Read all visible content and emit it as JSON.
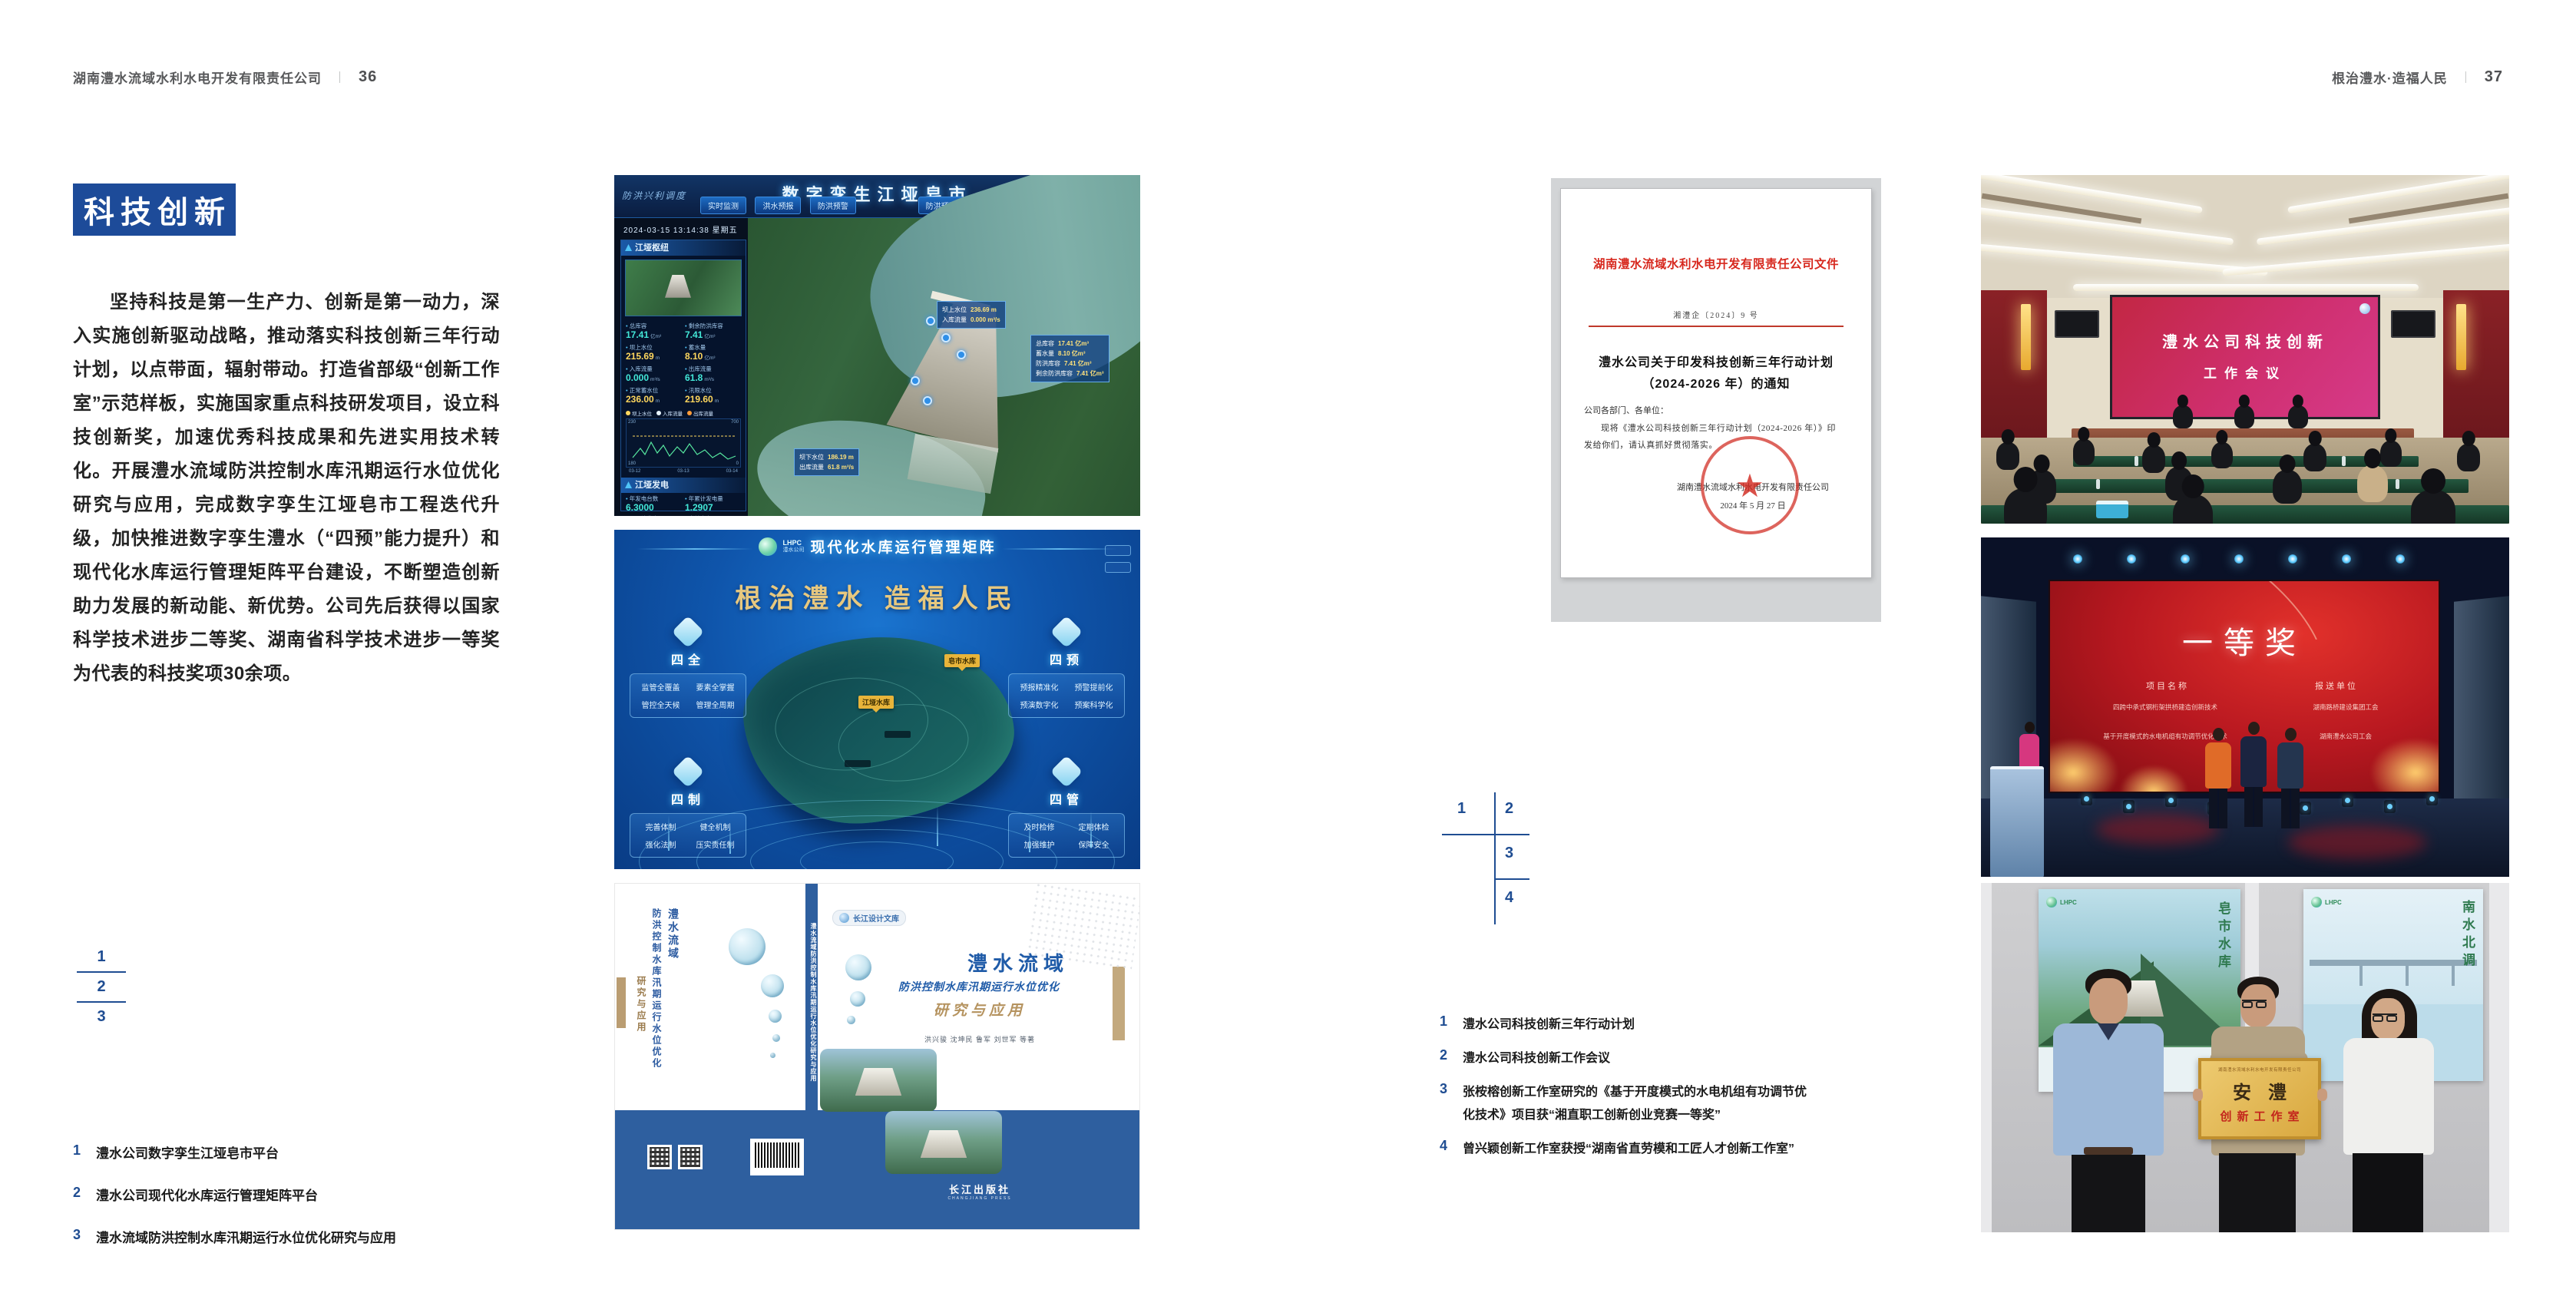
{
  "colors": {
    "accent_blue": "#1d4b99",
    "index_blue": "#1f4d92",
    "doc_red": "#d7281e",
    "gold": "#c9a063"
  },
  "left_page": {
    "header": {
      "company": "湖南澧水流域水利水电开发有限责任公司",
      "divider": "｜",
      "page": "36"
    },
    "badge": "科技创新",
    "paragraph": "坚持科技是第一生产力、创新是第一动力，深入实施创新驱动战略，推动落实科技创新三年行动计划，以点带面，辐射带动。打造省部级“创新工作室”示范样板，实施国家重点科技研发项目，设立科技创新奖，加速优秀科技成果和先进实用技术转化。开展澧水流域防洪控制水库汛期运行水位优化研究与应用，完成数字孪生江垭皂市工程迭代升级，加快推进数字孪生澧水（“四预”能力提升）和现代化水库运行管理矩阵平台建设，不断塑造创新助力发展的新动能、新优势。公司先后获得以国家科学技术进步二等奖、湖南省科学技术进步一等奖为代表的科技奖项30余项。",
    "index": [
      "1",
      "2",
      "3"
    ],
    "captions": [
      {
        "num": "1",
        "text": "澧水公司数字孪生江垭皂市平台"
      },
      {
        "num": "2",
        "text": "澧水公司现代化水库运行管理矩阵平台"
      },
      {
        "num": "3",
        "text": "澧水流域防洪控制水库汛期运行水位优化研究与应用"
      }
    ]
  },
  "right_page": {
    "header": {
      "slogan": "根治澧水·造福人民",
      "divider": "｜",
      "page": "37"
    },
    "index": [
      "1",
      "2",
      "3",
      "4"
    ],
    "captions": [
      {
        "num": "1",
        "text": "澧水公司科技创新三年行动计划"
      },
      {
        "num": "2",
        "text": "澧水公司科技创新工作会议"
      },
      {
        "num": "3",
        "text": "张桉榕创新工作室研究的《基于开度模式的水电机组有功调节优化技术》项目获“湘直职工创新创业竞赛一等奖”"
      },
      {
        "num": "4",
        "text": "曾兴颖创新工作室获授“湖南省直劳模和工匠人才创新工作室”"
      }
    ]
  },
  "twin": {
    "corner": "防洪兴利调度",
    "title": "数字孪生江垭皂市",
    "datetime": "2024-03-15 13:14:38 星期五",
    "tabs_left": [
      "实时监测",
      "洪水预报",
      "防洪预警"
    ],
    "tabs_right": [
      "防洪预演",
      "预案生成",
      "调度执行",
      "工程巡检"
    ],
    "panel1": "江垭枢纽",
    "stats": [
      {
        "label": "总库容",
        "value": "17.41",
        "unit": "亿m³"
      },
      {
        "label": "剩余防洪库容",
        "value": "7.41",
        "unit": "亿m³"
      },
      {
        "label": "坝上水位",
        "value": "215.69",
        "unit": "m"
      },
      {
        "label": "蓄水量",
        "value": "8.10",
        "unit": "亿m³"
      },
      {
        "label": "入库流量",
        "value": "0.000",
        "unit": "m³/s"
      },
      {
        "label": "出库流量",
        "value": "61.8",
        "unit": "m³/s"
      },
      {
        "label": "正常蓄水位",
        "value": "236.00",
        "unit": "m"
      },
      {
        "label": "汛限水位",
        "value": "219.60",
        "unit": "m"
      }
    ],
    "legend": [
      "坝上水位",
      "入库流量",
      "出库流量"
    ],
    "axis": {
      "y_top": "230",
      "y_bottom": "180",
      "y2_top": "700",
      "y2_bottom": "0"
    },
    "x_labels": [
      "03-12",
      "03-13",
      "03-14"
    ],
    "panel2": "江垭发电",
    "gen": [
      {
        "label": "年发电台数",
        "value": "6.3000"
      },
      {
        "label": "年累计发电量",
        "value": "1.2907"
      },
      {
        "label": "月累计发电量",
        "value": "3359.21"
      },
      {
        "label": "当前出力",
        "value": "0.00"
      },
      {
        "label": "发电流量",
        "value": "0.00"
      },
      {
        "label": "弃水流量",
        "value": "0.00"
      }
    ],
    "gauges": [
      "0.00",
      "102.98",
      "0.00"
    ],
    "callout_top": [
      {
        "label": "坝上水位",
        "value": "236.69 m"
      },
      {
        "label": "入库流量",
        "value": "0.000 m³/s"
      }
    ],
    "callout_right": [
      {
        "label": "总库容",
        "value": "17.41 亿m³"
      },
      {
        "label": "蓄水量",
        "value": "8.10 亿m³"
      },
      {
        "label": "防洪库容",
        "value": "7.41 亿m³"
      },
      {
        "label": "剩余防洪库容",
        "value": "7.41 亿m³"
      }
    ],
    "callout_bottom": [
      {
        "label": "坝下水位",
        "value": "186.19 m"
      },
      {
        "label": "出库流量",
        "value": "61.8 m³/s"
      }
    ]
  },
  "matrix": {
    "logo": "LHPC",
    "logo_sub": "澧水公司",
    "title": "现代化水库运行管理矩阵",
    "slogan": "根治澧水  造福人民",
    "groups": [
      {
        "title": "四全",
        "items": [
          "监管全覆盖",
          "要素全掌握",
          "管控全天候",
          "管理全周期"
        ]
      },
      {
        "title": "四制",
        "items": [
          "完善体制",
          "健全机制",
          "强化法制",
          "压实责任制"
        ]
      },
      {
        "title": "四预",
        "items": [
          "预报精准化",
          "预警提前化",
          "预演数字化",
          "预案科学化"
        ]
      },
      {
        "title": "四管",
        "items": [
          "及时检修",
          "定期体检",
          "加强维护",
          "保障安全"
        ]
      }
    ],
    "labels": [
      "江垭水库",
      "皂市水库"
    ]
  },
  "book": {
    "series": "长江设计文库",
    "title": "澧水流域",
    "subtitle": "防洪控制水库汛期运行水位优化",
    "subtitle2": "研究与应用",
    "authors": "洪兴骏  沈坤民  鲁军  刘世军  等著",
    "publisher": "长江出版社",
    "publisher_en": "CHANGJIANG PRESS",
    "spine": "澧水流域防洪控制水库汛期运行水位优化研究与应用",
    "back_title1": "澧水流域",
    "back_title2": "防洪控制水库汛期运行水位优化",
    "back_title3": "研究与应用"
  },
  "doc": {
    "header": "湖南澧水流域水利水电开发有限责任公司文件",
    "number": "湘澧企〔2024〕9 号",
    "title1": "澧水公司关于印发科技创新三年行动计划",
    "title2": "（2024-2026 年）的通知",
    "salutation": "公司各部门、各单位：",
    "body1": "现将《澧水公司科技创新三年行动计划（2024-2026 年）》印",
    "body2": "发给你们，请认真抓好贯彻落实。",
    "signer": "湖南澧水流域水利水电开发有限责任公司",
    "date": "2024 年 5 月 27 日",
    "seal_star": "★"
  },
  "meeting": {
    "screen1": "澧水公司科技创新",
    "screen2": "工作会议"
  },
  "award": {
    "headline": "一等奖",
    "col1": "项目名称",
    "col2": "报送单位",
    "rows": [
      {
        "project": "四跨中承式钢桁架拱桥建造创新技术",
        "org": "湖南路桥建设集团工会"
      },
      {
        "project": "基于开度模式的水电机组有功调节优化技术",
        "org": "湖南澧水公司工会"
      }
    ]
  },
  "group": {
    "plaque_header": "湖南澧水流域水利水电开发有限责任公司",
    "plaque_big": "安澧",
    "plaque_sub": "创新工作室",
    "poster_left_logo": "LHPC",
    "poster_left_vert": "皂市水库",
    "poster_right_logo": "LHPC",
    "poster_right_vert": "南水北调"
  }
}
